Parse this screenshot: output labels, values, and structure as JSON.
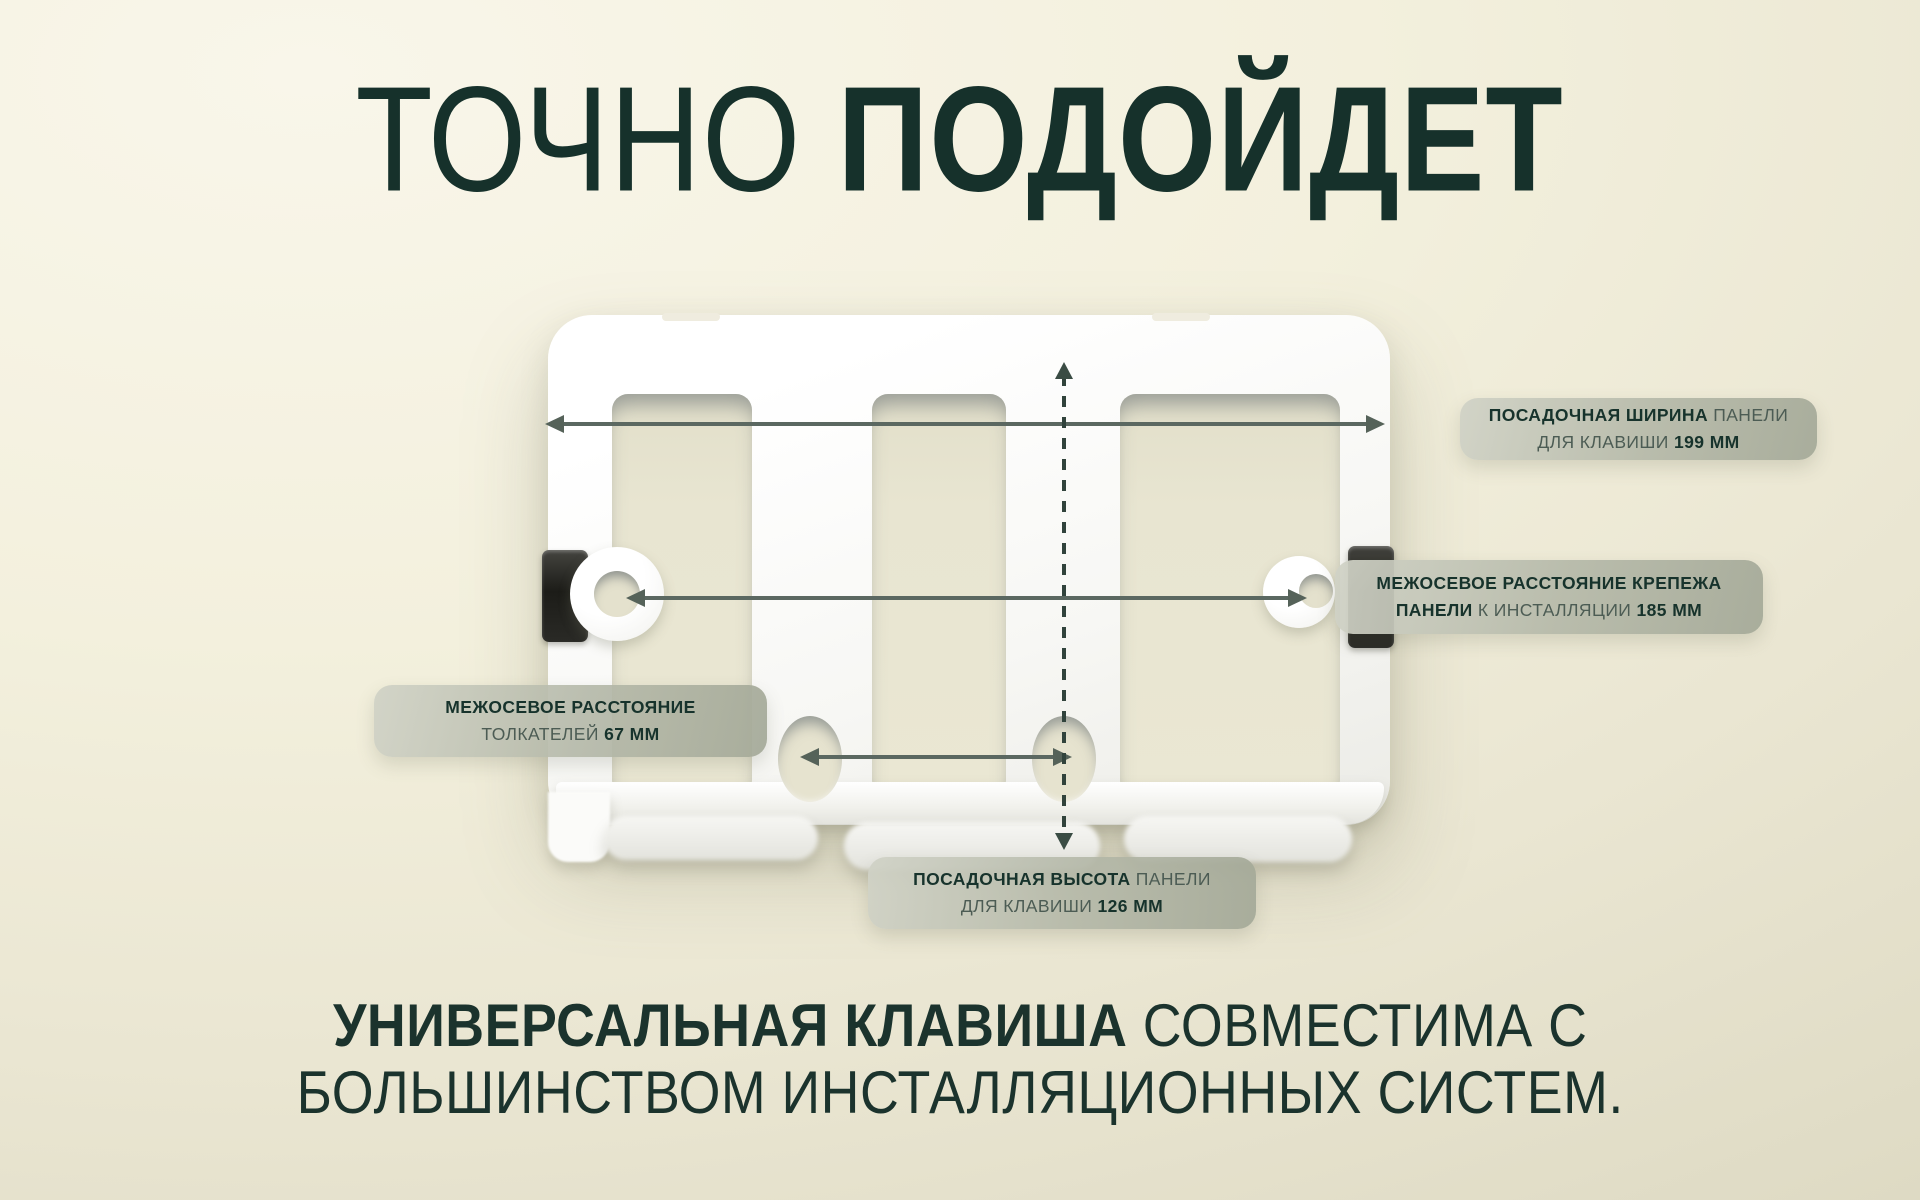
{
  "title": {
    "light": "ТОЧНО",
    "bold": "ПОДОЙДЕТ"
  },
  "callouts": {
    "width": {
      "line1_bold": "ПОСАДОЧНАЯ ШИРИНА",
      "line1_reg": " ПАНЕЛИ",
      "line2_reg": "ДЛЯ КЛАВИШИ ",
      "line2_bold": "199 ММ"
    },
    "fixing": {
      "line1_bold": "МЕЖОСЕВОЕ РАССТОЯНИЕ КРЕПЕЖА",
      "line2_bold_a": "ПАНЕЛИ",
      "line2_reg": " К ИНСТАЛЛЯЦИИ ",
      "line2_bold_b": "185 ММ"
    },
    "pushers": {
      "line1_bold": "МЕЖОСЕВОЕ РАССТОЯНИЕ",
      "line2_reg": "ТОЛКАТЕЛЕЙ ",
      "line2_bold": "67 ММ"
    },
    "height": {
      "line1_bold": "ПОСАДОЧНАЯ ВЫСОТА",
      "line1_reg": " ПАНЕЛИ",
      "line2_reg": "ДЛЯ КЛАВИШИ ",
      "line2_bold": "126 ММ"
    }
  },
  "dimensions_mm": {
    "seat_width": 199,
    "fixing_distance": 185,
    "pushers_distance": 67,
    "seat_height": 126
  },
  "footer": {
    "line1_bold": "УНИВЕРСАЛЬНАЯ КЛАВИША",
    "line1_reg": " СОВМЕСТИМА С",
    "line2": "БОЛЬШИНСТВОМ ИНСТАЛЛЯЦИОННЫХ СИСТЕМ."
  },
  "colors": {
    "heading_text": "#16312b",
    "callout_text_bold": "#17332c",
    "callout_text_regular": "#4c5c54",
    "callout_background": "#b4b8a8",
    "arrow": "#5b6861",
    "dashed_arrow": "#31433c",
    "background_light": "#f9f6ea",
    "background_dark": "#dcd8c1",
    "product_body": "#ffffff",
    "mounting_clip": "#23231f"
  }
}
